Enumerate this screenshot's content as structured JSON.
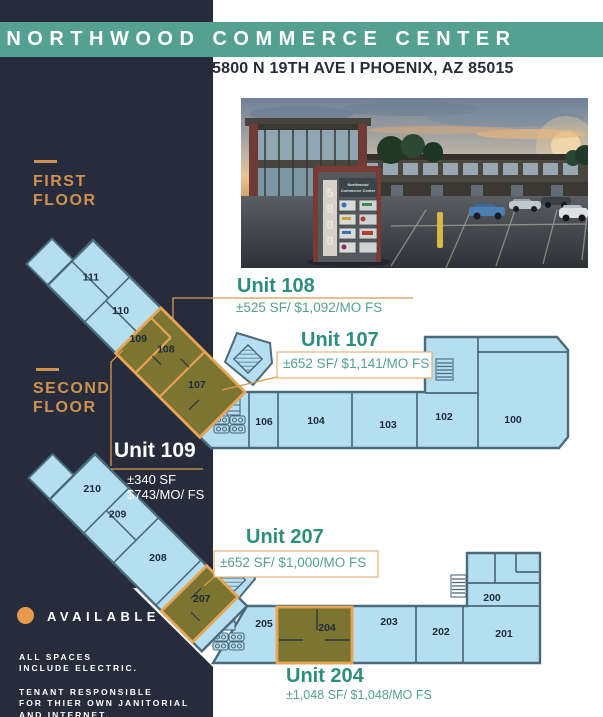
{
  "header": {
    "title": "NORTHWOOD COMMERCE CENTER",
    "address": "5800 N 19TH AVE I PHOENIX, AZ 85015"
  },
  "photo": {
    "sign_number": "5800",
    "sign_line1": "Northwood",
    "sign_line2": "Commerce Center"
  },
  "floors": {
    "first": {
      "line1": "FIRST",
      "line2": "FLOOR"
    },
    "second": {
      "line1": "SECOND",
      "line2": "FLOOR"
    }
  },
  "units": {
    "u108": {
      "title": "Unit 108",
      "details": "±525 SF/ $1,092/MO FS"
    },
    "u107": {
      "title": "Unit 107",
      "details": "±652 SF/ $1,141/MO FS"
    },
    "u109": {
      "title": "Unit 109",
      "size": "±340 SF",
      "price": "$743/MO/ FS"
    },
    "u207": {
      "title": "Unit 207",
      "details": "±652 SF/ $1,000/MO FS"
    },
    "u204": {
      "title": "Unit 204",
      "details": "±1,048 SF/ $1,048/MO FS"
    }
  },
  "rooms": {
    "f1": {
      "r111": "111",
      "r110": "110",
      "r109": "109",
      "r108": "108",
      "r107": "107",
      "r106": "106",
      "r104": "104",
      "r103": "103",
      "r102": "102",
      "r100": "100"
    },
    "f2": {
      "r210": "210",
      "r209": "209",
      "r208": "208",
      "r207": "207",
      "r205": "205",
      "r204": "204",
      "r203": "203",
      "r202": "202",
      "r201": "201",
      "r200": "200"
    }
  },
  "legend": {
    "available": "AVAILABLE"
  },
  "notes": {
    "p1_line1": "ALL SPACES",
    "p1_line2": "INCLUDE ELECTRIC.",
    "p2_line1": "TENANT RESPONSIBLE",
    "p2_line2": "FOR THIER OWN JANITORIAL",
    "p2_line3": "AND INTERNET."
  },
  "colors": {
    "navy": "#262c3c",
    "teal_banner": "#55a191",
    "teal_text": "#2e8e7e",
    "orange_accent": "#cf9150",
    "plan_fill": "#b5dff1",
    "plan_wall": "#4b6a7a",
    "highlight_fill": "#7c7531",
    "highlight_border": "#e8a455",
    "available_dot": "#e89a4a"
  }
}
